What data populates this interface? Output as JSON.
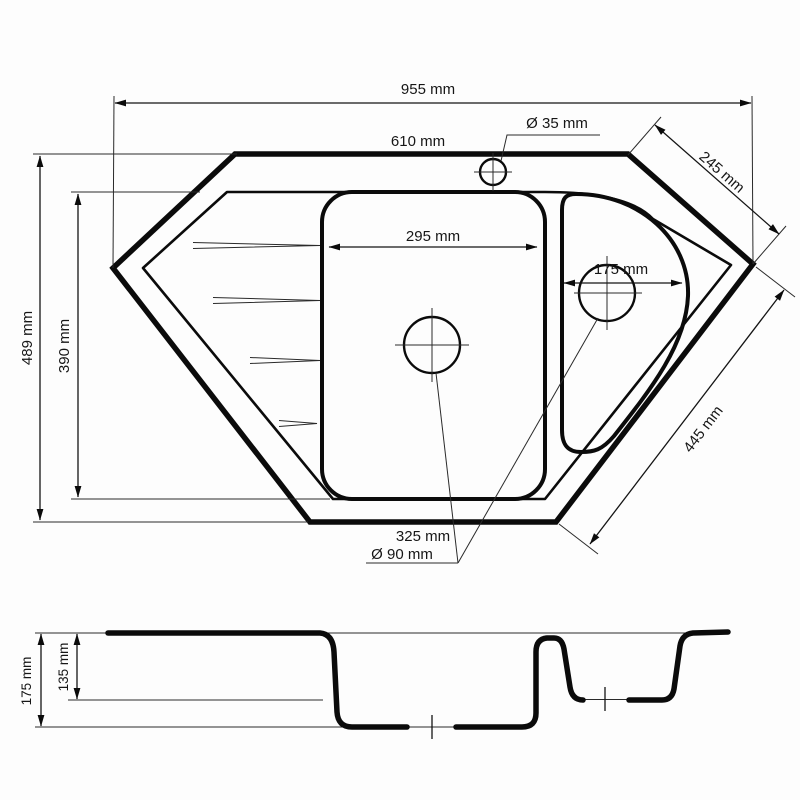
{
  "drawing": {
    "background": "#fdfdfd",
    "line_color": "#0b0b0b",
    "units": "mm",
    "top_view": {
      "overall_width": "955 mm",
      "top_edge": "610 mm",
      "faucet_hole_diameter": "Ø 35 mm",
      "right_top_edge": "245 mm",
      "overall_depth": "489 mm",
      "inner_depth": "390 mm",
      "main_bowl_width": "295 mm",
      "small_bowl_width": "175 mm",
      "right_bottom_edge": "445 mm",
      "bottom_edge": "325 mm",
      "drain_diameter": "Ø 90 mm"
    },
    "section_view": {
      "total_depth": "175 mm",
      "small_bowl_depth": "135 mm"
    }
  }
}
